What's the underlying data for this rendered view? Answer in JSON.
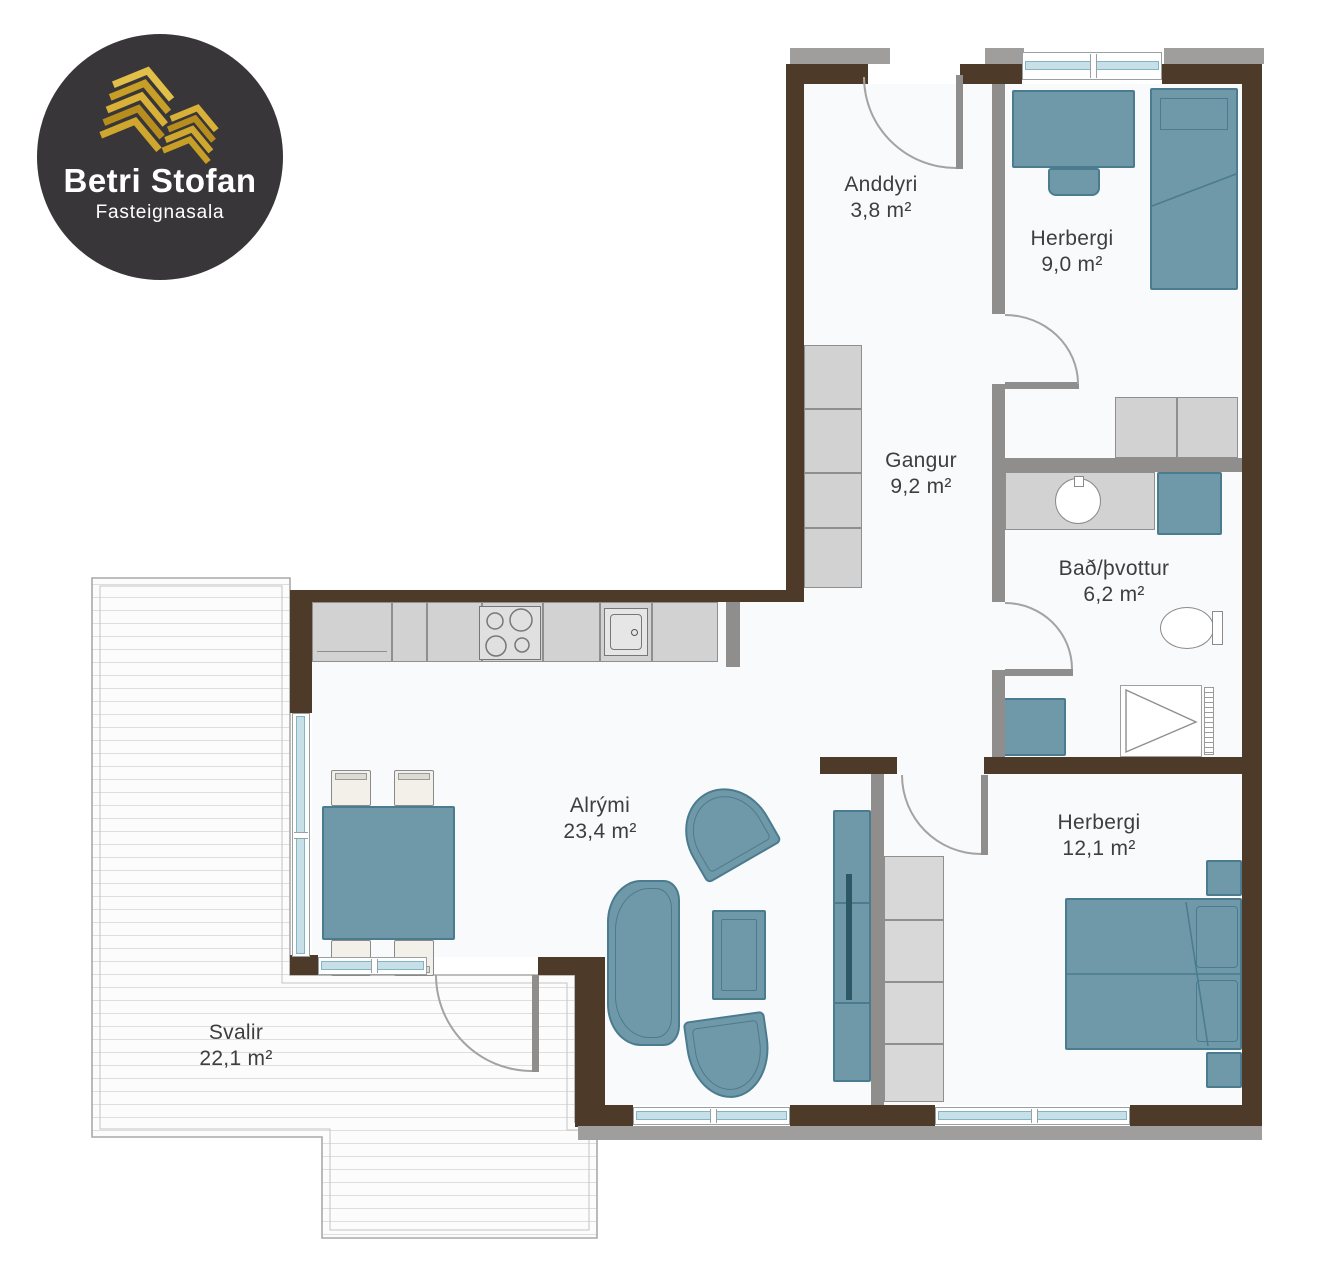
{
  "logo": {
    "title": "Betri Stofan",
    "subtitle": "Fasteignasala"
  },
  "rooms": {
    "anddyri": {
      "name": "Anddyri",
      "area": "3,8 m²"
    },
    "herbergi_small": {
      "name": "Herbergi",
      "area": "9,0 m²"
    },
    "gangur": {
      "name": "Gangur",
      "area": "9,2 m²"
    },
    "bad": {
      "name": "Bað/þvottur",
      "area": "6,2 m²"
    },
    "alrymi": {
      "name": "Alrými",
      "area": "23,4 m²"
    },
    "herbergi_master": {
      "name": "Herbergi",
      "area": "12,1 m²"
    },
    "svalir": {
      "name": "Svalir",
      "area": "22,1 m²"
    }
  },
  "colors": {
    "wall_brown": "#4d3a29",
    "wall_gray": "#908e8c",
    "lintel_gray": "#a09e9c",
    "furniture_teal": "#6f99a8",
    "furniture_teal_border": "#4a7b8e",
    "furniture_gray": "#d2d2d2",
    "furniture_gray_border": "#8f8f8f",
    "glass": "#c7e0e8",
    "floor": "#f8fafb",
    "deck_line": "#dedede",
    "label_text": "#3e3e3e",
    "logo_bg": "#393639",
    "logo_gold": "#d9b139",
    "arc": "#a5a3a1"
  }
}
